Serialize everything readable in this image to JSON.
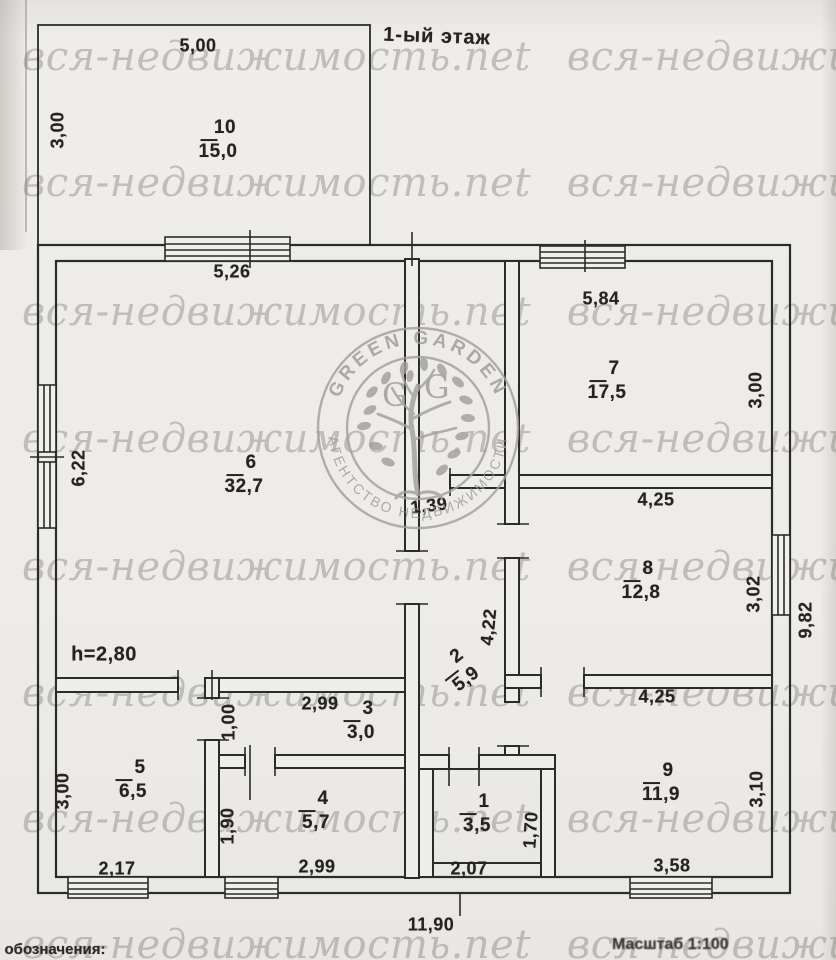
{
  "title": "1-ый этаж",
  "watermark_text": "вся-недвижимость.net",
  "footer": {
    "legend": "е обозначения:",
    "scale": "Масштаб 1:100"
  },
  "logo": {
    "top_arc": "GREEN GARDEN",
    "bottom_arc": "АГЕНТСТВО НЕДВИЖИМОСТИ",
    "monogram_left": "G",
    "monogram_right": "G"
  },
  "plan": {
    "ceiling_height": "h=2,80",
    "overall_width": "11,90",
    "rooms": [
      {
        "number": "10",
        "area": "15,0",
        "x": 218,
        "y": 140,
        "rot": 0
      },
      {
        "number": "6",
        "area": "32,7",
        "x": 244,
        "y": 475,
        "rot": 0
      },
      {
        "number": "7",
        "area": "17,5",
        "x": 607,
        "y": 381,
        "rot": 0
      },
      {
        "number": "8",
        "area": "12,8",
        "x": 641,
        "y": 581,
        "rot": 0
      },
      {
        "number": "2",
        "area": "5,9",
        "x": 459,
        "y": 670,
        "rot": -38
      },
      {
        "number": "3",
        "area": "3,0",
        "x": 361,
        "y": 721,
        "rot": 0
      },
      {
        "number": "5",
        "area": "6,5",
        "x": 133,
        "y": 780,
        "rot": 0
      },
      {
        "number": "4",
        "area": "5,7",
        "x": 316,
        "y": 811,
        "rot": 0
      },
      {
        "number": "1",
        "area": "3,5",
        "x": 477,
        "y": 814,
        "rot": 0
      },
      {
        "number": "9",
        "area": "11,9",
        "x": 661,
        "y": 783,
        "rot": 0
      }
    ],
    "dimensions": [
      {
        "text": "5,00",
        "x": 198,
        "y": 46,
        "rot": 0
      },
      {
        "text": "3,00",
        "x": 58,
        "y": 130,
        "rot": -90
      },
      {
        "text": "5,26",
        "x": 232,
        "y": 272,
        "rot": 0
      },
      {
        "text": "5,84",
        "x": 601,
        "y": 299,
        "rot": 0
      },
      {
        "text": "3,00",
        "x": 756,
        "y": 390,
        "rot": -90
      },
      {
        "text": "6,22",
        "x": 79,
        "y": 468,
        "rot": -90
      },
      {
        "text": "1,39",
        "x": 429,
        "y": 506,
        "rot": -7
      },
      {
        "text": "4,25",
        "x": 656,
        "y": 500,
        "rot": 0
      },
      {
        "text": "3,02",
        "x": 754,
        "y": 594,
        "rot": -90
      },
      {
        "text": "9,82",
        "x": 806,
        "y": 620,
        "rot": -90
      },
      {
        "text": "4,22",
        "x": 489,
        "y": 627,
        "rot": -84
      },
      {
        "text": "2,99",
        "x": 320,
        "y": 704,
        "rot": 0
      },
      {
        "text": "1,00",
        "x": 229,
        "y": 722,
        "rot": -90
      },
      {
        "text": "4,25",
        "x": 657,
        "y": 697,
        "rot": 0
      },
      {
        "text": "3,00",
        "x": 63,
        "y": 791,
        "rot": -90
      },
      {
        "text": "3,10",
        "x": 757,
        "y": 789,
        "rot": -90
      },
      {
        "text": "1,90",
        "x": 228,
        "y": 826,
        "rot": -90
      },
      {
        "text": "1,70",
        "x": 531,
        "y": 830,
        "rot": -86
      },
      {
        "text": "2,17",
        "x": 117,
        "y": 869,
        "rot": 0
      },
      {
        "text": "2,99",
        "x": 317,
        "y": 867,
        "rot": 0
      },
      {
        "text": "2,07",
        "x": 469,
        "y": 869,
        "rot": 0
      },
      {
        "text": "3,58",
        "x": 672,
        "y": 866,
        "rot": 0
      },
      {
        "text": "11,90",
        "x": 431,
        "y": 925,
        "rot": 0
      }
    ]
  },
  "colors": {
    "paper": "#eeece8",
    "ink": "#2b2b28",
    "watermark": "#7a7772",
    "stamp": "#a2a09b"
  }
}
